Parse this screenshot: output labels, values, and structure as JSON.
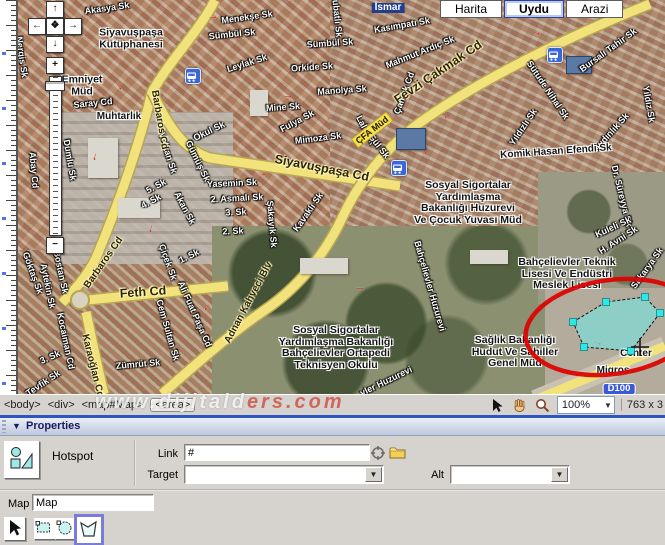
{
  "map": {
    "type_buttons": [
      {
        "label": "Harita",
        "selected": false
      },
      {
        "label": "Uydu",
        "selected": true
      },
      {
        "label": "Arazi",
        "selected": false
      }
    ],
    "labels": [
      {
        "text": "Akasya Sk",
        "x": 107,
        "y": 8,
        "r": -8
      },
      {
        "text": "Menekşe Sk",
        "x": 247,
        "y": 17,
        "r": -8
      },
      {
        "text": "Sümbül Sk",
        "x": 232,
        "y": 34,
        "r": -6
      },
      {
        "text": "Sümbül Sk",
        "x": 330,
        "y": 43,
        "r": -4
      },
      {
        "text": "Leylak Sk",
        "x": 247,
        "y": 63,
        "r": -18
      },
      {
        "text": "Orkide Sk",
        "x": 312,
        "y": 67,
        "r": -4
      },
      {
        "text": "Manolya Sk",
        "x": 342,
        "y": 90,
        "r": -4
      },
      {
        "text": "Mine Sk",
        "x": 283,
        "y": 107,
        "r": -4
      },
      {
        "text": "Fulya Sk",
        "x": 297,
        "y": 121,
        "r": -28
      },
      {
        "text": "Nergis Sk",
        "x": 22,
        "y": 57,
        "r": 82
      },
      {
        "text": "Ulubatlı Sk",
        "x": 337,
        "y": 14,
        "r": 84
      },
      {
        "text": "Kasımpatı Sk",
        "x": 402,
        "y": 25,
        "r": -10
      },
      {
        "text": "Mahmut Ardıç Sk",
        "x": 420,
        "y": 52,
        "r": -22
      },
      {
        "text": "Çamlık Cd",
        "x": 404,
        "y": 93,
        "r": -70
      },
      {
        "text": "Bursalı Tahir Sk",
        "x": 608,
        "y": 50,
        "r": -36
      },
      {
        "text": "Sütude Nihal Sk",
        "x": 548,
        "y": 90,
        "r": 56
      },
      {
        "text": "Yıldızlı Sk",
        "x": 523,
        "y": 127,
        "r": -56
      },
      {
        "text": "Aydınlık Sk",
        "x": 611,
        "y": 132,
        "r": -48
      },
      {
        "text": "Yıldız Sk",
        "x": 649,
        "y": 104,
        "r": 80
      },
      {
        "text": "Dr. Süreyya Sk",
        "x": 622,
        "y": 196,
        "r": 76
      },
      {
        "text": "Kuleli Sk",
        "x": 613,
        "y": 227,
        "r": -25
      },
      {
        "text": "Saray Cd",
        "x": 93,
        "y": 103,
        "r": -6
      },
      {
        "text": "Okul Sk",
        "x": 209,
        "y": 131,
        "r": -26
      },
      {
        "text": "Dumlu Sk",
        "x": 70,
        "y": 160,
        "r": 80
      },
      {
        "text": "Volkan Sk",
        "x": 168,
        "y": 153,
        "r": 72
      },
      {
        "text": "Gümüş Sk",
        "x": 198,
        "y": 161,
        "r": 64
      },
      {
        "text": "Abay Cd",
        "x": 34,
        "y": 170,
        "r": 85
      },
      {
        "text": "5. Sk",
        "x": 156,
        "y": 186,
        "r": -28
      },
      {
        "text": "4. Sk",
        "x": 151,
        "y": 201,
        "r": -28
      },
      {
        "text": "Akan Sk",
        "x": 185,
        "y": 208,
        "r": 62
      },
      {
        "text": "Mimoza Sk",
        "x": 318,
        "y": 138,
        "r": -7
      },
      {
        "text": "Yasemin Sk",
        "x": 232,
        "y": 183,
        "r": -3
      },
      {
        "text": "2. Asmalı Sk",
        "x": 237,
        "y": 198,
        "r": -3
      },
      {
        "text": "3. Sk",
        "x": 236,
        "y": 212,
        "r": -3
      },
      {
        "text": "2. Sk",
        "x": 233,
        "y": 231,
        "r": -3
      },
      {
        "text": "Şakayık Sk",
        "x": 272,
        "y": 224,
        "r": 85
      },
      {
        "text": "Kavaklı Sk",
        "x": 308,
        "y": 212,
        "r": -55
      },
      {
        "text": "Lale Sk",
        "x": 366,
        "y": 130,
        "r": 62
      },
      {
        "text": "Gül Sk",
        "x": 379,
        "y": 146,
        "r": 52
      },
      {
        "text": "Göktaş Sk",
        "x": 33,
        "y": 273,
        "r": 70
      },
      {
        "text": "Bostan Sk",
        "x": 61,
        "y": 272,
        "r": 78
      },
      {
        "text": "Aytekin Sk",
        "x": 48,
        "y": 286,
        "r": 78
      },
      {
        "text": "Çiçek Sk",
        "x": 168,
        "y": 262,
        "r": 70
      },
      {
        "text": "1. Sk",
        "x": 189,
        "y": 256,
        "r": -26
      },
      {
        "text": "Ali Fuat Paşa Cd",
        "x": 195,
        "y": 314,
        "r": 66
      },
      {
        "text": "Cem Sultan Sk",
        "x": 168,
        "y": 330,
        "r": 74
      },
      {
        "text": "Kocaiman Cd",
        "x": 66,
        "y": 341,
        "r": 78
      },
      {
        "text": "3. Sk",
        "x": 50,
        "y": 357,
        "r": -24
      },
      {
        "text": "Tevfik Sk",
        "x": 43,
        "y": 383,
        "r": -34
      },
      {
        "text": "Zümrüt Sk",
        "x": 138,
        "y": 364,
        "r": -5
      },
      {
        "text": "Bahçelievler Huzurevi",
        "x": 430,
        "y": 286,
        "r": 74
      },
      {
        "text": "vler Huzurevi",
        "x": 386,
        "y": 381,
        "r": -26
      },
      {
        "text": "H. Avni Sk",
        "x": 618,
        "y": 240,
        "r": -33
      },
      {
        "text": "Sakarya Sk",
        "x": 647,
        "y": 268,
        "r": -54
      },
      {
        "text": "Komik Hasan Efendi Sk",
        "x": 556,
        "y": 152,
        "r": -4,
        "kind": "poi"
      },
      {
        "text": "Barbaros Cd",
        "x": 159,
        "y": 120,
        "r": 80,
        "kind": "road"
      },
      {
        "text": "Barbaros Cd",
        "x": 104,
        "y": 263,
        "r": -55,
        "kind": "road"
      },
      {
        "text": "Siyavuşpaşa Cd",
        "x": 322,
        "y": 168,
        "r": 11,
        "kind": "road",
        "big": true
      },
      {
        "text": "Fevzi Çakmak Cd",
        "x": 438,
        "y": 72,
        "r": -34,
        "kind": "road",
        "big": true
      },
      {
        "text": "Feth Cd",
        "x": 143,
        "y": 292,
        "r": -4,
        "kind": "road",
        "big": true
      },
      {
        "text": "Adnan Kahveci Blv",
        "x": 249,
        "y": 303,
        "r": -62,
        "kind": "road"
      },
      {
        "text": "Karaoğlan Cd",
        "x": 92,
        "y": 366,
        "r": 76,
        "kind": "road"
      },
      {
        "text": "ÇFA Müd",
        "x": 372,
        "y": 130,
        "r": -38,
        "kind": "roadbox"
      },
      {
        "text": "İsmar",
        "x": 388,
        "y": 8,
        "kind": "box"
      },
      {
        "lines": [
          "Siyavuşpaşa",
          "Kütüphanesi"
        ],
        "x": 131,
        "y": 39,
        "kind": "poim"
      },
      {
        "lines": [
          "Emniyet",
          "Müd"
        ],
        "x": 82,
        "y": 86,
        "kind": "poim"
      },
      {
        "text": "Muhtarlık",
        "x": 119,
        "y": 117,
        "kind": "poi"
      },
      {
        "lines": [
          "Sosyal Sigortalar",
          "Yardımlaşma",
          "Bakanlığı Huzurevi",
          "Ve Çocuk Yuvası Müd"
        ],
        "x": 468,
        "y": 203,
        "kind": "poim"
      },
      {
        "lines": [
          "Bahçelievler Teknik",
          "Lisesi Ve Endüstri",
          "Meslek Lisesi"
        ],
        "x": 567,
        "y": 274,
        "kind": "poim"
      },
      {
        "lines": [
          "Sosyal Sigortalar",
          "Yardımlaşma Bakanlığı",
          "Bahçelievler Ortapedi",
          "Teknisyen Okulu"
        ],
        "x": 336,
        "y": 348,
        "kind": "poim"
      },
      {
        "lines": [
          "Sağlık Bakanlığı",
          "Hudut Ve Sahiller",
          "Genel Müd"
        ],
        "x": 515,
        "y": 352,
        "kind": "poim"
      },
      {
        "text": "Migros",
        "x": 613,
        "y": 371,
        "kind": "poi"
      },
      {
        "text": "Center",
        "x": 636,
        "y": 354,
        "kind": "poi"
      },
      {
        "text": "D100",
        "x": 619,
        "y": 389,
        "kind": "shield"
      }
    ],
    "arrows": [
      {
        "x": 213,
        "y": 16,
        "r": 0
      },
      {
        "x": 288,
        "y": 95,
        "r": 0
      },
      {
        "x": 537,
        "y": 32,
        "r": 20
      },
      {
        "x": 447,
        "y": 119,
        "r": 205
      },
      {
        "x": 427,
        "y": 155,
        "r": 205
      },
      {
        "x": 262,
        "y": 173,
        "r": 5
      },
      {
        "x": 152,
        "y": 229,
        "r": 100
      },
      {
        "x": 208,
        "y": 308,
        "r": 130
      },
      {
        "x": 598,
        "y": 342,
        "r": 15
      },
      {
        "x": 641,
        "y": 396,
        "r": 10
      },
      {
        "x": 120,
        "y": 86,
        "r": 50
      },
      {
        "x": 96,
        "y": 157,
        "r": 100
      },
      {
        "x": 360,
        "y": 287,
        "r": 0
      }
    ],
    "bus_stops": [
      {
        "x": 192,
        "y": 75
      },
      {
        "x": 554,
        "y": 54
      },
      {
        "x": 398,
        "y": 167
      }
    ]
  },
  "hotspot": {
    "polygon_points": [
      [
        573,
        322
      ],
      [
        606,
        302
      ],
      [
        645,
        297
      ],
      [
        660,
        313
      ],
      [
        631,
        351
      ],
      [
        584,
        347
      ]
    ],
    "fill_color": "#6eebeb",
    "handle_color": "#2ee8e8",
    "annotation_ellipse": {
      "cx": 612,
      "cy": 327,
      "rx": 87,
      "ry": 47,
      "rot": -8,
      "color": "#dd0000"
    },
    "cursor": {
      "x": 640,
      "y": 347
    }
  },
  "status": {
    "tag_path": [
      "<body>",
      "<div>",
      "<map#Map>",
      "<area>"
    ],
    "selected_tag": "<area>",
    "zoom_value": "100%",
    "dimensions": "763 x 3",
    "watermark_left": "www.dijitald",
    "watermark_right": "ers.com"
  },
  "properties": {
    "header": "Properties",
    "element_type": "Hotspot",
    "link_label": "Link",
    "link_value": "#",
    "target_label": "Target",
    "target_value": "",
    "alt_label": "Alt",
    "alt_value": "",
    "map_label": "Map",
    "map_value": "Map"
  },
  "colors": {
    "panel_bg": "#d6d3ce",
    "road_yellow": "#f2e27c",
    "hotspot_cyan": "#6eebeb",
    "annotation_red": "#dd0000",
    "selected_tool_border": "#7b7bd8",
    "shield_blue": "#3b5bd6"
  }
}
